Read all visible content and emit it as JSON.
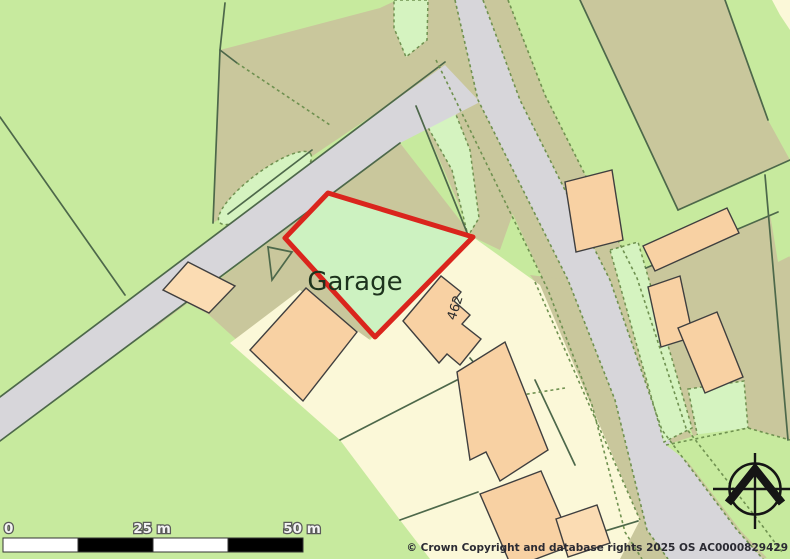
{
  "map": {
    "plot_label": "Garage",
    "house_number": "462",
    "scale_bar": {
      "label_0": "0",
      "label_25": "25 m",
      "label_50": "50 m"
    },
    "copyright": "© Crown Copyright and database rights 2025 OS AC0000829429",
    "colors": {
      "field_green": "#c7ea9e",
      "mint_green": "#d5f3c0",
      "plot_green": "#cdf2c1",
      "khaki": "#c9c79c",
      "road_grey": "#d7d6da",
      "cream": "#fbf8d8",
      "building_peach": "#f8d1a3",
      "building_peach_light": "#fbdcb3",
      "boundary_green": "#4d684a",
      "dashed_olive": "#6f9150",
      "plot_outline_red": "#da251d",
      "building_outline": "#3f3f3f",
      "scale_white": "#ffffff",
      "scale_black": "#000000"
    },
    "icons": {
      "compass": "compass-rose-north"
    }
  }
}
